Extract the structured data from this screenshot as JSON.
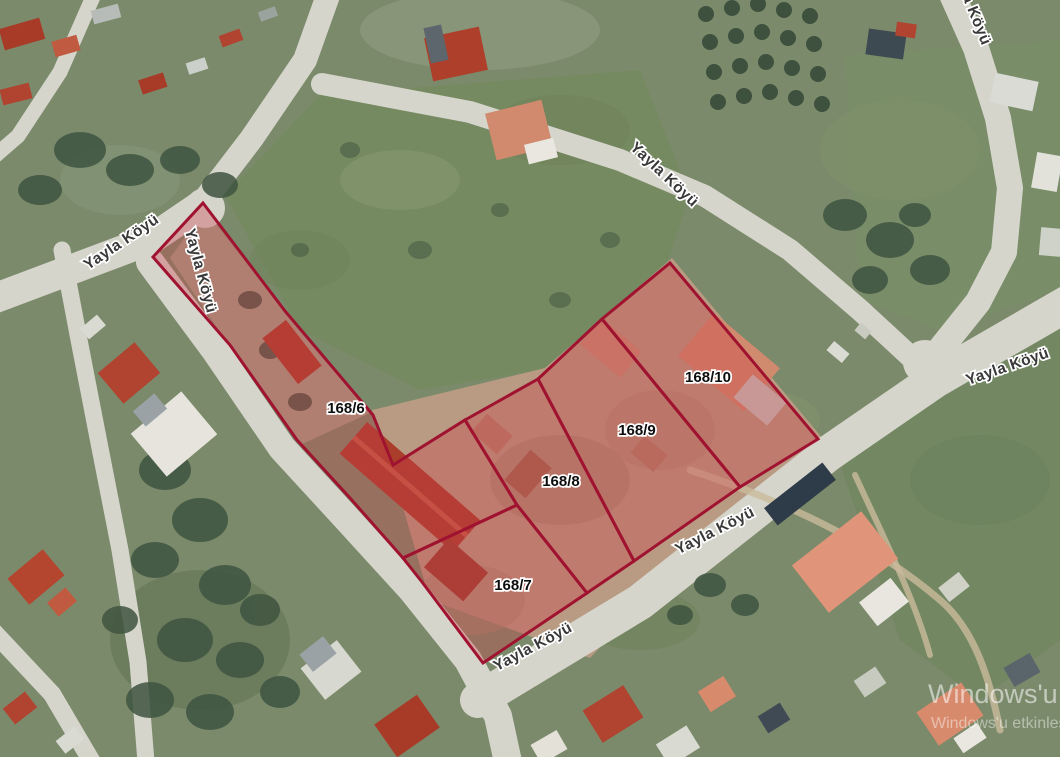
{
  "map": {
    "parcels": [
      {
        "id": "168/6"
      },
      {
        "id": "168/7"
      },
      {
        "id": "168/8"
      },
      {
        "id": "168/9"
      },
      {
        "id": "168/10"
      }
    ],
    "street_labels": [
      {
        "text": "Yayla Köyü"
      },
      {
        "text": "Yayla Köyü"
      },
      {
        "text": "Yayla Köyü"
      },
      {
        "text": "Yayla Köyü"
      },
      {
        "text": "Yayla Köyü"
      },
      {
        "text": "Yayla Köyü"
      },
      {
        "text": "Yayla Köyü"
      }
    ],
    "colors": {
      "parcel_stroke": "#a01330",
      "parcel_fill": "rgba(204,62,72,0.34)",
      "road": "#d6d5cc",
      "grass": "#7b8a6b",
      "dirt": "#b89b82",
      "street_label": "#383838",
      "parcel_label": "#0d0d0d"
    },
    "watermark": {
      "line1": "Windows'u",
      "line2": "Windows'u etkinleşt"
    }
  }
}
